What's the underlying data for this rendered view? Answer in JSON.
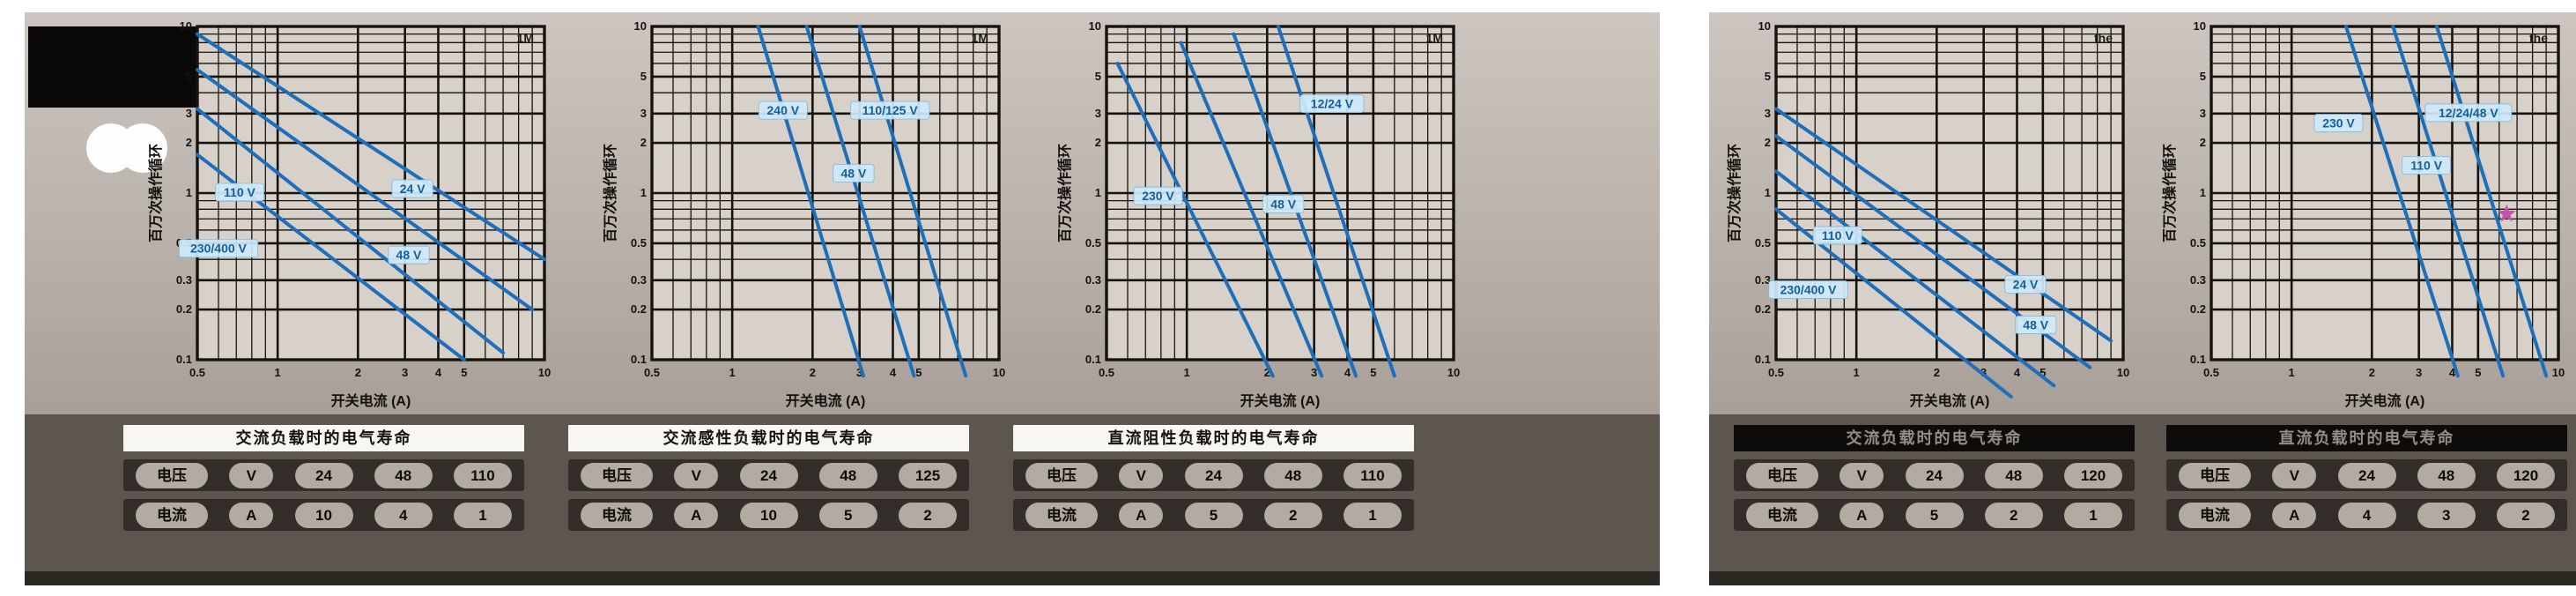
{
  "ui": {
    "y_axis_label": "百万次操作循环",
    "x_axis_label": "开关电流 (A)",
    "corner_note_left": "1M",
    "corner_note_right": "the",
    "row_labels": {
      "voltage": "电压",
      "current": "电流",
      "voltage_unit": "V",
      "current_unit": "A"
    }
  },
  "colors": {
    "panel_bg": "#b6aea7",
    "plot_bg": "#d7d1ca",
    "grid": "#16130f",
    "curve": "#1f6fb8",
    "curve_label_bg": "#cfe9fa",
    "curve_label_text": "#135f9e",
    "star": "#c353a8",
    "table_strip": "#5d564e"
  },
  "panels": {
    "left": {
      "tables": [
        {
          "header": "交流负载时的电气寿命",
          "voltages": [
            "24",
            "48",
            "110"
          ],
          "currents": [
            "10",
            "4",
            "1"
          ]
        },
        {
          "header": "交流感性负载时的电气寿命",
          "voltages": [
            "24",
            "48",
            "125"
          ],
          "currents": [
            "10",
            "5",
            "2"
          ]
        },
        {
          "header": "直流阻性负载时的电气寿命",
          "voltages": [
            "24",
            "48",
            "110"
          ],
          "currents": [
            "5",
            "2",
            "1"
          ]
        }
      ]
    },
    "right": {
      "tables": [
        {
          "header": "交流负载时的电气寿命",
          "voltages": [
            "24",
            "48",
            "120"
          ],
          "currents": [
            "5",
            "2",
            "1"
          ]
        },
        {
          "header": "直流负载时的电气寿命",
          "voltages": [
            "24",
            "48",
            "120"
          ],
          "currents": [
            "4",
            "3",
            "2"
          ]
        }
      ]
    }
  },
  "chart_data": [
    {
      "panel": "left",
      "type": "line",
      "title": "",
      "xlabel": "开关电流 (A)",
      "ylabel": "百万次操作循环",
      "xscale": "log",
      "yscale": "log",
      "xlim": [
        0.5,
        10
      ],
      "ylim": [
        0.1,
        10
      ],
      "xticks": [
        0.5,
        1,
        2,
        3,
        4,
        5,
        10
      ],
      "yticks": [
        0.1,
        0.2,
        0.3,
        0.5,
        1,
        2,
        3,
        5,
        10
      ],
      "grid": true,
      "legend": "inline-labels",
      "corner_note": "1M",
      "series": [
        {
          "name": "24 V",
          "points": [
            [
              0.5,
              9.0
            ],
            [
              10,
              0.4
            ]
          ],
          "label_at": [
            3.2,
            1.05
          ]
        },
        {
          "name": "48 V",
          "points": [
            [
              0.5,
              5.5
            ],
            [
              9.0,
              0.2
            ]
          ],
          "label_at": [
            3.1,
            0.42
          ]
        },
        {
          "name": "110 V",
          "points": [
            [
              0.5,
              3.2
            ],
            [
              7.0,
              0.11
            ]
          ],
          "label_at": [
            0.72,
            1.0
          ]
        },
        {
          "name": "230/400 V",
          "points": [
            [
              0.5,
              1.7
            ],
            [
              5.0,
              0.1
            ]
          ],
          "label_at": [
            0.6,
            0.46
          ]
        }
      ],
      "marker": null
    },
    {
      "panel": "left",
      "type": "line",
      "title": "",
      "xlabel": "开关电流 (A)",
      "ylabel": "百万次操作循环",
      "xscale": "log",
      "yscale": "log",
      "xlim": [
        0.5,
        10
      ],
      "ylim": [
        0.1,
        10
      ],
      "xticks": [
        0.5,
        1,
        2,
        3,
        4,
        5,
        10
      ],
      "yticks": [
        0.1,
        0.2,
        0.3,
        0.5,
        1,
        2,
        3,
        5,
        10
      ],
      "grid": true,
      "legend": "inline-labels",
      "corner_note": "1M",
      "series": [
        {
          "name": "240 V",
          "points": [
            [
              1.25,
              10
            ],
            [
              3.1,
              0.08
            ]
          ],
          "label_at": [
            1.55,
            3.1
          ]
        },
        {
          "name": "110/125 V",
          "points": [
            [
              1.9,
              10
            ],
            [
              4.8,
              0.08
            ]
          ],
          "label_at": [
            3.9,
            3.1
          ]
        },
        {
          "name": "48 V",
          "points": [
            [
              3.0,
              10
            ],
            [
              7.5,
              0.08
            ]
          ],
          "label_at": [
            2.85,
            1.3
          ]
        }
      ],
      "marker": null
    },
    {
      "panel": "left",
      "type": "line",
      "title": "",
      "xlabel": "开关电流 (A)",
      "ylabel": "百万次操作循环",
      "xscale": "log",
      "yscale": "log",
      "xlim": [
        0.5,
        10
      ],
      "ylim": [
        0.1,
        10
      ],
      "xticks": [
        0.5,
        1,
        2,
        3,
        4,
        5,
        10
      ],
      "yticks": [
        0.1,
        0.2,
        0.3,
        0.5,
        1,
        2,
        3,
        5,
        10
      ],
      "grid": true,
      "legend": "inline-labels",
      "corner_note": "1M",
      "series": [
        {
          "name": "230 V",
          "points": [
            [
              0.55,
              6.0
            ],
            [
              2.1,
              0.08
            ]
          ],
          "label_at": [
            0.78,
            0.95
          ]
        },
        {
          "name": "110 V",
          "points": [
            [
              0.95,
              8.0
            ],
            [
              3.2,
              0.08
            ]
          ],
          "label_at": null
        },
        {
          "name": "48 V",
          "points": [
            [
              1.5,
              9.0
            ],
            [
              4.3,
              0.08
            ]
          ],
          "label_at": [
            2.3,
            0.85
          ]
        },
        {
          "name": "12/24 V",
          "points": [
            [
              2.2,
              10
            ],
            [
              6.0,
              0.08
            ]
          ],
          "label_at": [
            3.5,
            3.4
          ]
        }
      ],
      "marker": null
    },
    {
      "panel": "right",
      "type": "line",
      "title": "",
      "xlabel": "开关电流 (A)",
      "ylabel": "百万次操作循环",
      "xscale": "log",
      "yscale": "log",
      "xlim": [
        0.5,
        10
      ],
      "ylim": [
        0.1,
        10
      ],
      "xticks": [
        0.5,
        1,
        2,
        3,
        4,
        5,
        10
      ],
      "yticks": [
        0.1,
        0.2,
        0.3,
        0.5,
        1,
        2,
        3,
        5,
        10
      ],
      "grid": true,
      "legend": "inline-labels",
      "corner_note": "the",
      "series": [
        {
          "name": "24 V",
          "points": [
            [
              0.5,
              3.2
            ],
            [
              9.0,
              0.13
            ]
          ],
          "label_at": [
            4.3,
            0.28
          ]
        },
        {
          "name": "48 V",
          "points": [
            [
              0.5,
              2.2
            ],
            [
              7.5,
              0.09
            ]
          ],
          "label_at": [
            4.7,
            0.16
          ]
        },
        {
          "name": "110 V",
          "points": [
            [
              0.5,
              1.35
            ],
            [
              5.5,
              0.07
            ]
          ],
          "label_at": [
            0.85,
            0.55
          ]
        },
        {
          "name": "230/400 V",
          "points": [
            [
              0.5,
              0.8
            ],
            [
              3.8,
              0.06
            ]
          ],
          "label_at": [
            0.66,
            0.26
          ]
        }
      ],
      "marker": null
    },
    {
      "panel": "right",
      "type": "line",
      "title": "",
      "xlabel": "开关电流 (A)",
      "ylabel": "百万次操作循环",
      "xscale": "log",
      "yscale": "log",
      "xlim": [
        0.5,
        10
      ],
      "ylim": [
        0.1,
        10
      ],
      "xticks": [
        0.5,
        1,
        2,
        3,
        4,
        5,
        10
      ],
      "yticks": [
        0.1,
        0.2,
        0.3,
        0.5,
        1,
        2,
        3,
        5,
        10
      ],
      "grid": true,
      "legend": "inline-labels",
      "corner_note": "the",
      "series": [
        {
          "name": "230 V",
          "points": [
            [
              1.6,
              10
            ],
            [
              4.2,
              0.08
            ]
          ],
          "label_at": [
            1.5,
            2.6
          ]
        },
        {
          "name": "110 V",
          "points": [
            [
              2.4,
              10
            ],
            [
              6.2,
              0.08
            ]
          ],
          "label_at": [
            3.2,
            1.45
          ]
        },
        {
          "name": "12/24/48 V",
          "points": [
            [
              3.5,
              10
            ],
            [
              9.0,
              0.08
            ]
          ],
          "label_at": [
            4.6,
            3.0
          ]
        }
      ],
      "marker": {
        "type": "star",
        "at": [
          6.4,
          0.75
        ],
        "color": "#c353a8"
      }
    }
  ]
}
